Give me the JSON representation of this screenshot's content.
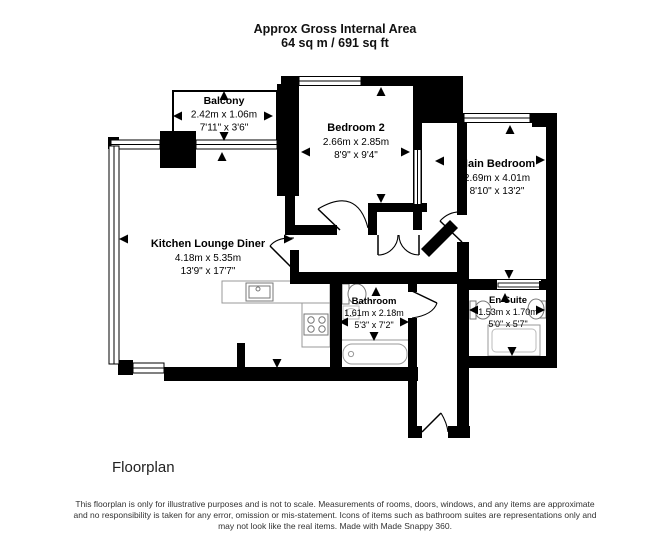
{
  "header": {
    "line1": "Approx Gross Internal Area",
    "line2": "64 sq m / 691 sq ft"
  },
  "rooms": {
    "balcony": {
      "name": "Balcony",
      "metric": "2.42m x 1.06m",
      "imperial": "7'11\" x 3'6\""
    },
    "bedroom2": {
      "name": "Bedroom 2",
      "metric": "2.66m x 2.85m",
      "imperial": "8'9\" x 9'4\""
    },
    "main_bedroom": {
      "name": "Main Bedroom",
      "metric": "2.69m x 4.01m",
      "imperial": "8'10\" x 13'2\""
    },
    "kitchen": {
      "name": "Kitchen Lounge Diner",
      "metric": "4.18m x 5.35m",
      "imperial": "13'9\" x 17'7\""
    },
    "bathroom": {
      "name": "Bathroom",
      "metric": "1.61m x 2.18m",
      "imperial": "5'3\" x 7'2\""
    },
    "en_suite": {
      "name": "En Suite",
      "metric": "1.53m x 1.70m",
      "imperial": "5'0\" x 5'7\""
    }
  },
  "footer": {
    "caption": "Floorplan",
    "line1": "This floorplan is only for illustrative purposes and is not to scale. Measurements of rooms, doors, windows, and any items are approximate",
    "line2": "and no responsibility is taken for any error, omission or mis-statement. Icons of items such as bathroom suites are representations only and",
    "line3": "may not look like the real items. Made with Made Snappy 360."
  },
  "colors": {
    "wall": "#000000",
    "background": "#ffffff",
    "fixture_outline": "#8a8a8a"
  }
}
